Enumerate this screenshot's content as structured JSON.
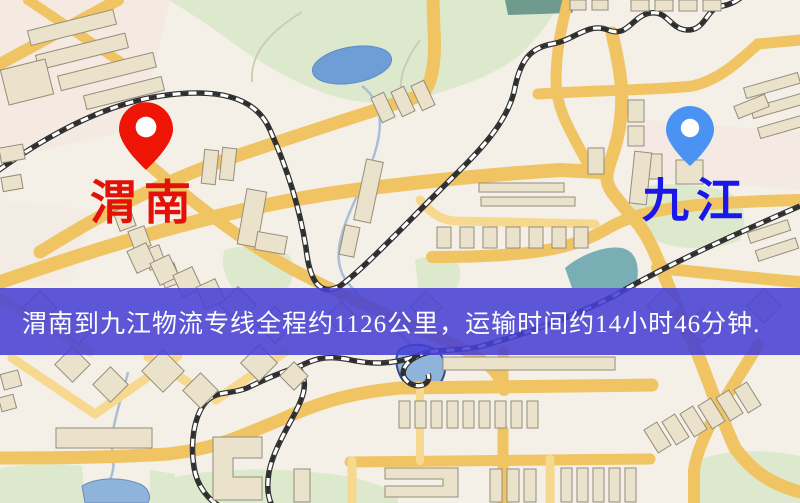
{
  "banner": {
    "text": "渭南到九江物流专线全程约1126公里，运输时间约14小时46分钟.",
    "origin_city": "渭南",
    "destination_city": "九江",
    "distance_text": "约1126公里",
    "duration_text": "约14小时46分钟",
    "background_color": "#463fd4",
    "text_color": "#ffffff"
  },
  "markers": {
    "origin": {
      "label": "渭南",
      "label_color": "#e31108",
      "pin_color": "#ee1506",
      "icon": "red-map-pin"
    },
    "destination": {
      "label": "九江",
      "label_color": "#1a17e8",
      "pin_color": "#4b93f2",
      "icon": "blue-map-pin"
    }
  },
  "map": {
    "colors": {
      "background": "#f4f0e7",
      "road_major": "#f0c363",
      "road_minor": "#f6d98f",
      "park_green": "#dde9cc",
      "water_lake": "#8fb4dc",
      "water_pond": "#6f9ed6",
      "water_teal": "#79aeb4",
      "building": "#eae2ca",
      "railway": "#2e2e2e"
    }
  }
}
